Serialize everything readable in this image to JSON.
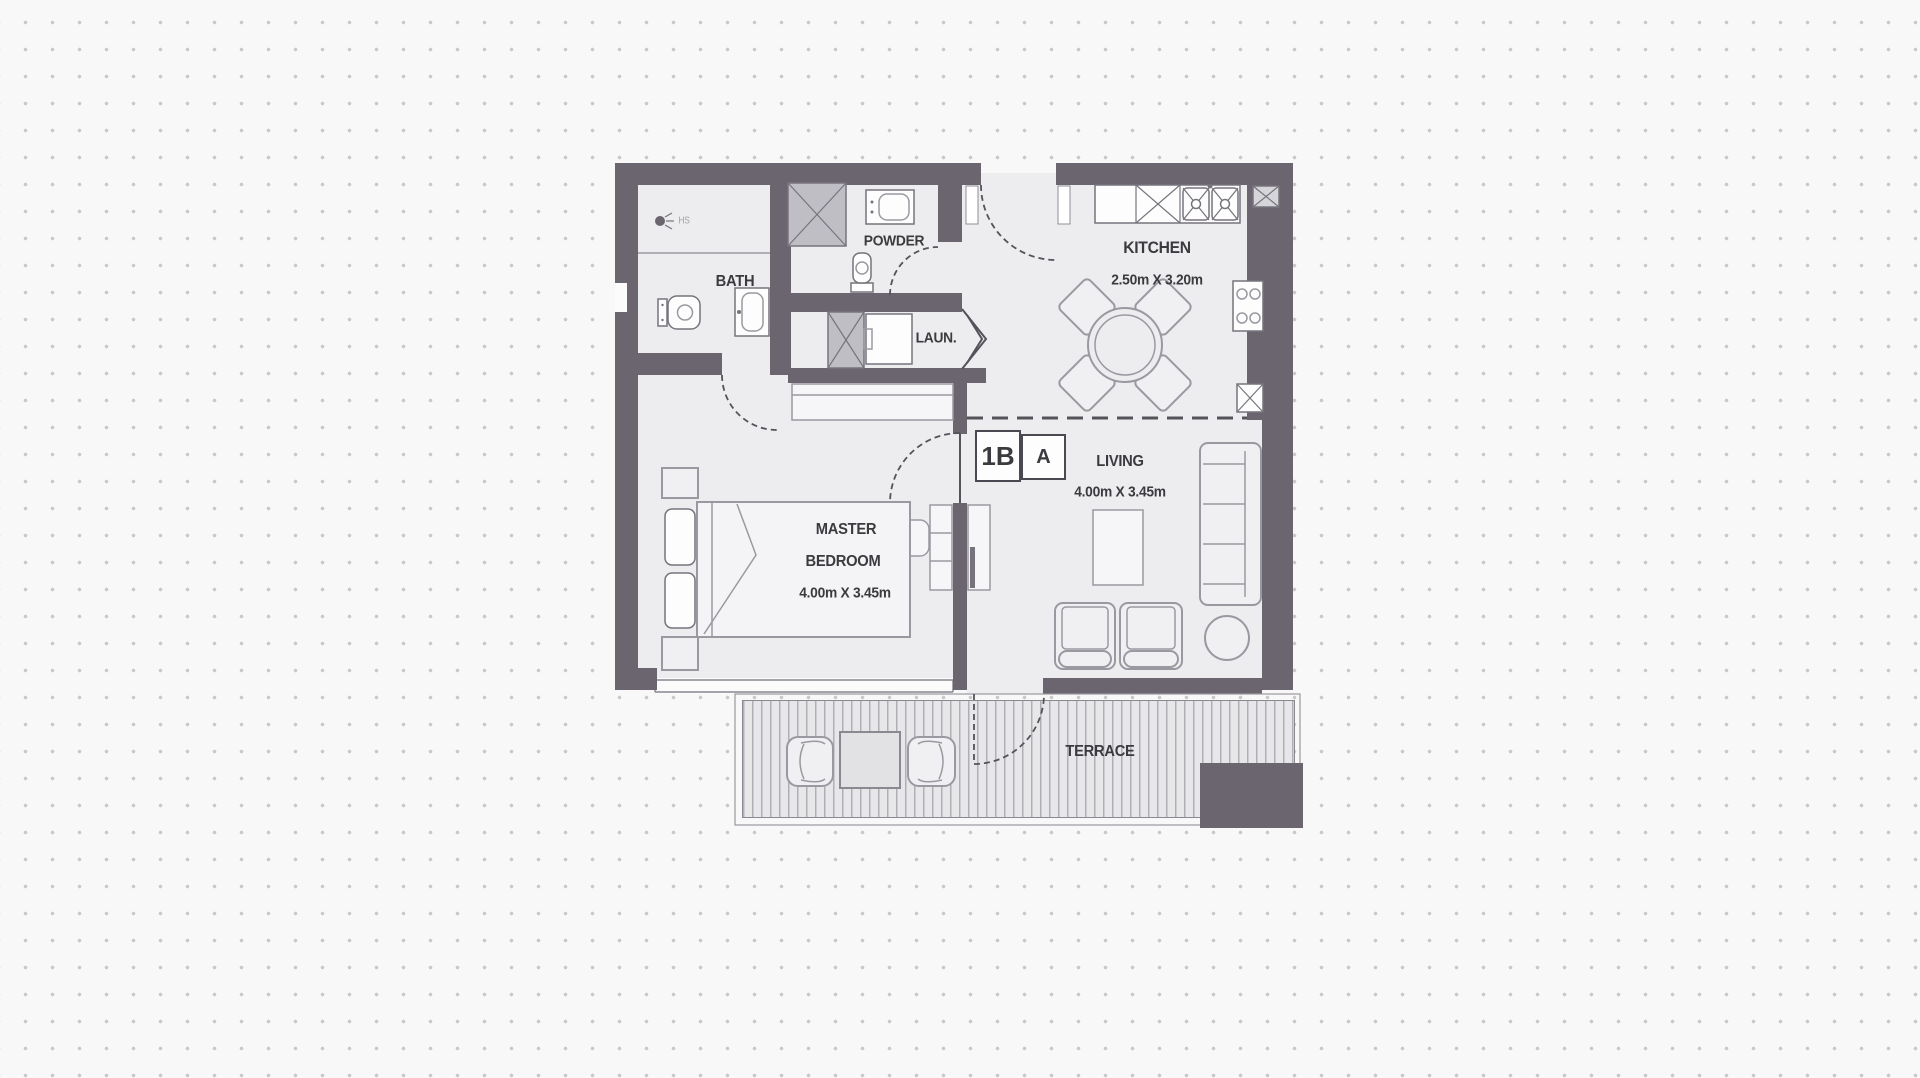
{
  "unit": {
    "type": "1B",
    "variant": "A"
  },
  "rooms": {
    "kitchen": {
      "name": "KITCHEN",
      "dims": "2.50m X 3.20m"
    },
    "living": {
      "name": "LIVING",
      "dims": "4.00m X 3.45m"
    },
    "master_bedroom": {
      "line1": "MASTER",
      "line2": "BEDROOM",
      "dims": "4.00m X 3.45m"
    },
    "bath": {
      "name": "BATH"
    },
    "shower": {
      "tag": "HS"
    },
    "powder": {
      "name": "POWDER"
    },
    "laundry": {
      "name": "LAUN."
    },
    "terrace": {
      "name": "TERRACE"
    }
  },
  "colors": {
    "page_bg": "#f8f8f8",
    "dot": "#c9c9c9",
    "wall": "#6b6570",
    "floor": "#ededef",
    "line": "#9a99a1",
    "dark_line": "#55525a",
    "text": "#3b3a3e",
    "shaft": "#c0bec5",
    "deck_stripe": "#b0afb5",
    "deck_bg": "#e7e7e9"
  }
}
